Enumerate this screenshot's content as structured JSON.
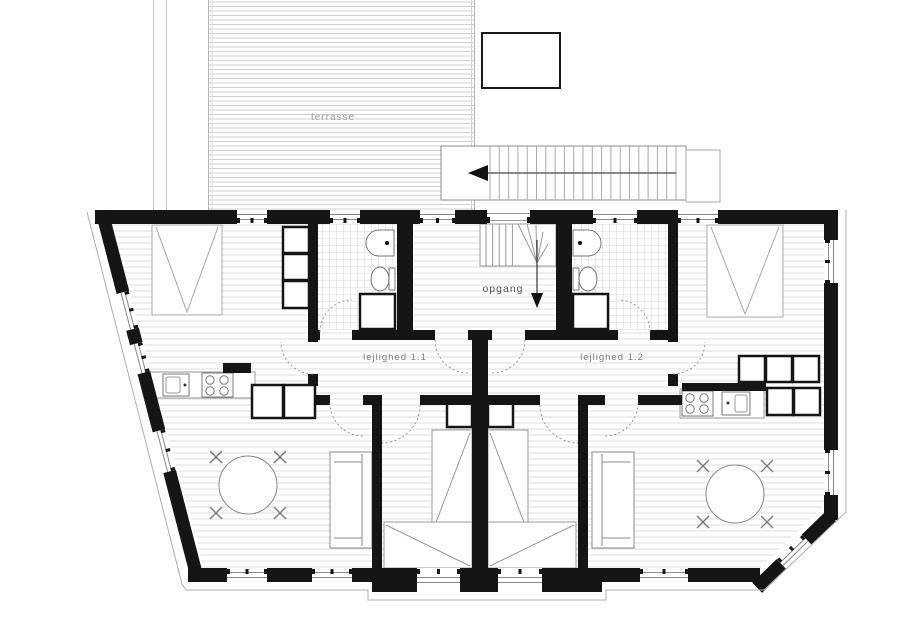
{
  "plan": {
    "type": "attic floor plan",
    "labels": {
      "terrace": "terrasse",
      "stair_hall": "opgang",
      "apartment_1": "lejlighed 1.1",
      "apartment_2": "lejlighed 1.2"
    },
    "rooms": [
      {
        "name": "terrace",
        "label": "terrasse"
      },
      {
        "name": "stair-hall",
        "label": "opgang"
      },
      {
        "name": "apartment-1-corridor",
        "label": "lejlighed 1.1"
      },
      {
        "name": "apartment-2-corridor",
        "label": "lejlighed 1.2"
      },
      {
        "name": "bathroom-1"
      },
      {
        "name": "bathroom-2"
      },
      {
        "name": "bedroom-1"
      },
      {
        "name": "bedroom-2"
      },
      {
        "name": "mid-bedroom-1"
      },
      {
        "name": "mid-bedroom-2"
      },
      {
        "name": "living-kitchen-1"
      },
      {
        "name": "living-kitchen-2"
      }
    ],
    "symbols": [
      "double-bed",
      "single-bed",
      "wardrobe",
      "closet",
      "desk",
      "kitchen-counter",
      "stove",
      "kitchen-sink",
      "bathroom-sink",
      "toilet",
      "shower",
      "dining-table",
      "chair",
      "sofa",
      "stair-run",
      "winder-stairs",
      "direction-arrow",
      "door-arc",
      "window"
    ],
    "colors": {
      "wall": "#151515",
      "floor_hatch": "#dedede",
      "terrace_hatch": "#d2d2d2",
      "tile_grid": "#cccccc",
      "furniture_line": "#888888",
      "label_gray": "#999999",
      "label_dark": "#555555",
      "background": "#ffffff"
    }
  }
}
